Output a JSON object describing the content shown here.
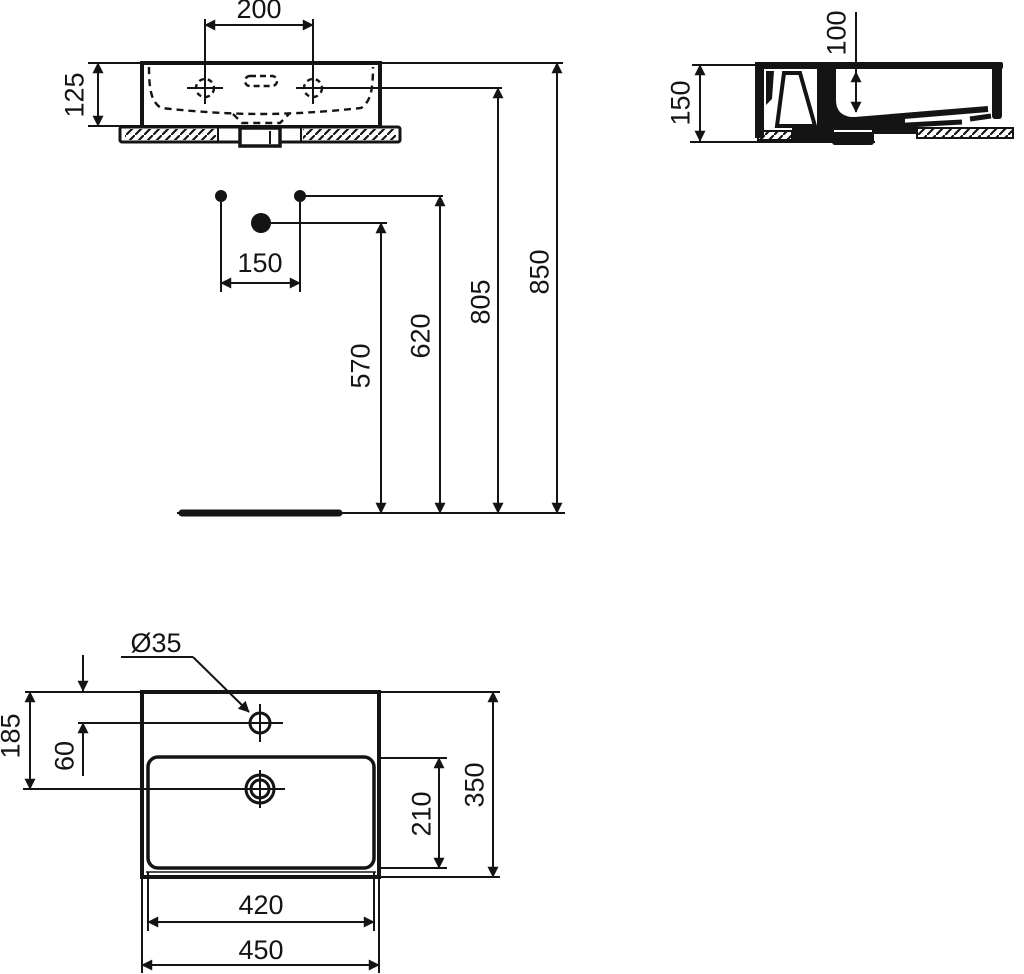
{
  "drawing": {
    "palette": {
      "line": "#141414",
      "background": "#ffffff"
    },
    "front_view": {
      "tap_hole_distance": "200",
      "rim_to_shelf": "125",
      "fixing_hole_distance": "150",
      "drain_height": "570",
      "fixing_hole_height": "620",
      "tap_hole_height": "805",
      "rim_height": "850"
    },
    "side_view": {
      "total_height": "150",
      "inner_depth": "100"
    },
    "top_view": {
      "tap_hole_diameter": "Ø35",
      "edge_to_drain": "185",
      "edge_to_tap_hole": "60",
      "bowl_width": "420",
      "overall_width": "450",
      "bowl_depth": "210",
      "overall_depth": "350"
    }
  }
}
